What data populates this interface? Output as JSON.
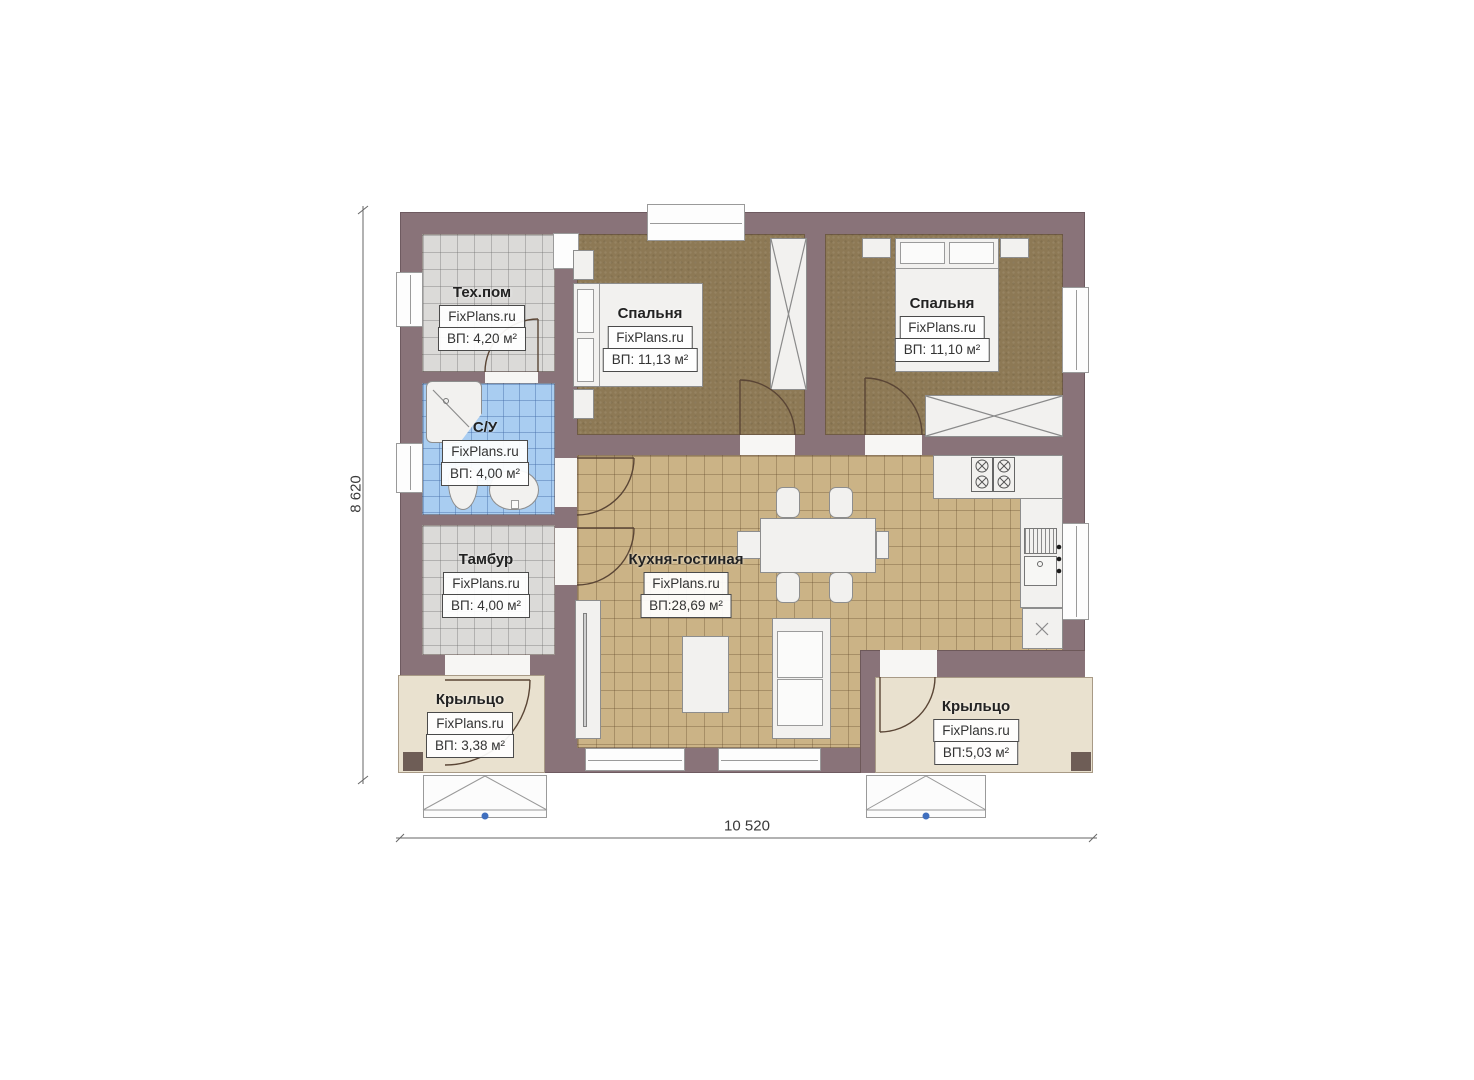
{
  "plan": {
    "brand": "FixPlans.ru",
    "rooms": [
      {
        "name": "Тех.пом",
        "brand": "FixPlans.ru",
        "area": "ВП: 4,20 м²"
      },
      {
        "name": "С/У",
        "brand": "FixPlans.ru",
        "area": "ВП: 4,00 м²"
      },
      {
        "name": "Тамбур",
        "brand": "FixPlans.ru",
        "area": "ВП: 4,00 м²"
      },
      {
        "name": "Спальня",
        "brand": "FixPlans.ru",
        "area": "ВП: 11,13 м²"
      },
      {
        "name": "Спальня",
        "brand": "FixPlans.ru",
        "area": "ВП: 11,10 м²"
      },
      {
        "name": "Кухня-гостиная",
        "brand": "FixPlans.ru",
        "area": "ВП:28,69 м²"
      },
      {
        "name": "Крыльцо",
        "brand": "FixPlans.ru",
        "area": "ВП: 3,38 м²"
      },
      {
        "name": "Крыльцо",
        "brand": "FixPlans.ru",
        "area": "ВП:5,03 м²"
      }
    ],
    "dimensions": {
      "width": "10 520",
      "height": "8 620"
    },
    "colors": {
      "wall": "#897379",
      "bedroom_floor": "#8d7955",
      "kitchen_floor": "#cbb386",
      "bathroom_floor": "#a9cdf1",
      "utility_floor": "#dbdad8",
      "porch_floor": "#e9e1cf",
      "furniture": "#f2f1ef",
      "door_arc": "#5a4535",
      "step_dot": "#3f6fbe"
    }
  }
}
